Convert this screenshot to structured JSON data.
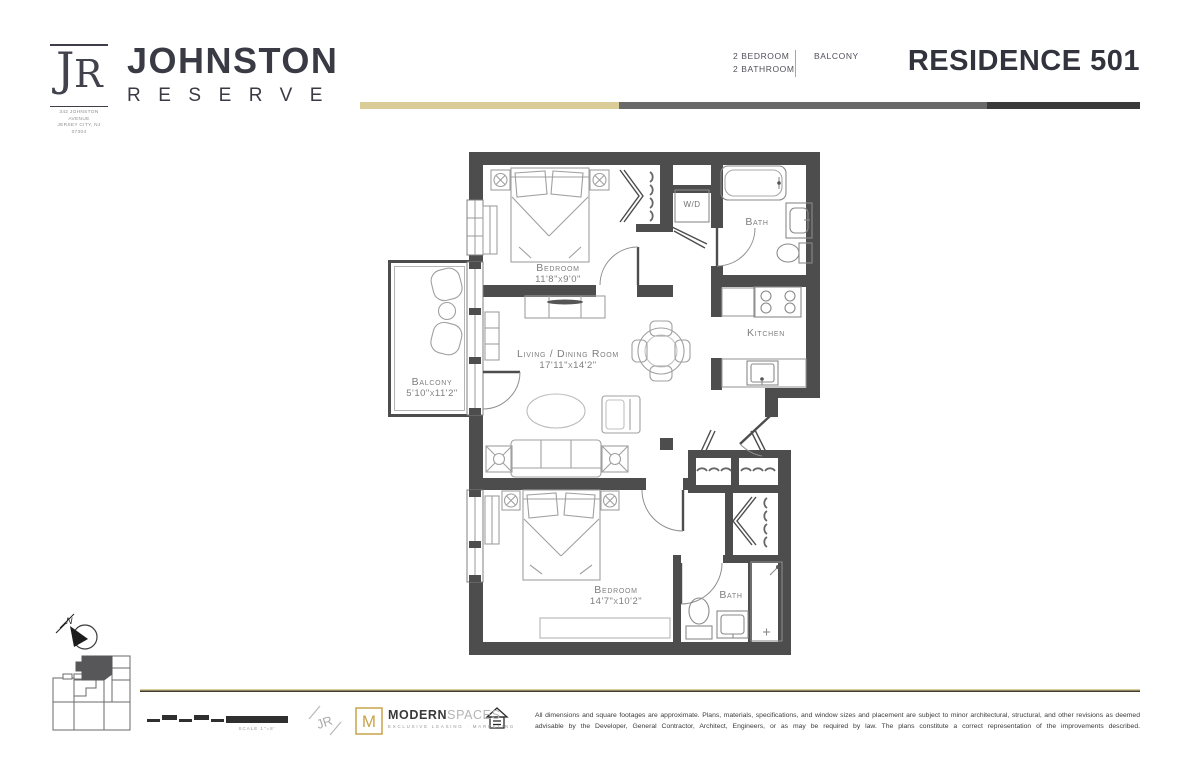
{
  "header": {
    "brand": {
      "monogram_j": "J",
      "monogram_r": "R",
      "name_top": "JOHNSTON",
      "name_bottom": "RESERVE",
      "address1": "342 JOHNSTON AVENUE",
      "address2": "JERSEY CITY, NJ 07304"
    },
    "unit": {
      "spec_line1": "2 BEDROOM",
      "spec_line2": "2 BATHROOM",
      "feature": "BALCONY",
      "title": "RESIDENCE 501"
    }
  },
  "plan": {
    "bedroom1": {
      "name": "Bedroom",
      "dims": "11'8\"x9'0\""
    },
    "living": {
      "name": "Living / Dining Room",
      "dims": "17'11\"x14'2\""
    },
    "balcony": {
      "name": "Balcony",
      "dims": "5'10\"x11'2\""
    },
    "bedroom2": {
      "name": "Bedroom",
      "dims": "14'7\"x10'2\""
    },
    "kitchen": {
      "name": "Kitchen"
    },
    "bath1": {
      "name": "Bath"
    },
    "bath2": {
      "name": "Bath"
    },
    "washer_dryer": {
      "name": "W/D"
    }
  },
  "footer": {
    "compass_n": "N",
    "scale_label": "SCALE 1\"=8'",
    "jr_mark": "JR",
    "brokerage": {
      "monogram": "M",
      "name_bold": "MODERN",
      "name_light": "SPACES",
      "tagline": "EXCLUSIVE LEASING · MARKETING"
    },
    "disclaimer": "All dimensions and square footages are approximate. Plans, materials, specifications, and window sizes and placement are subject to minor architectural, structural, and other revisions as deemed advisable by the Developer, General Contractor, Architect, Engineers, or as may be required by law. The plans constitute a correct representation of the improvements described."
  },
  "colors": {
    "wall": "#4d4d4d",
    "gold": "#d9cc96",
    "bar_mid": "#696969",
    "bar_dark": "#3a3a3a",
    "accent_gold": "#c8a44b"
  }
}
